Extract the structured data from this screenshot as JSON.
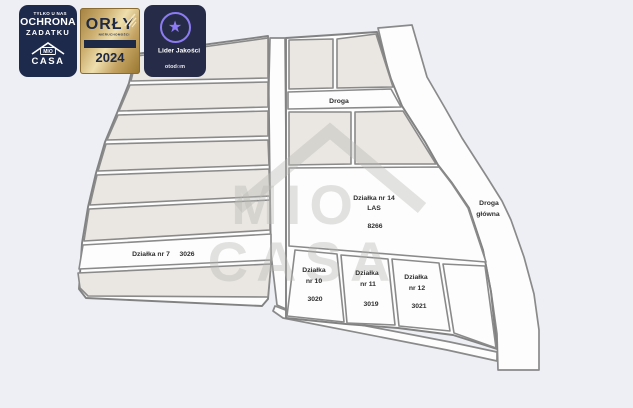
{
  "page": {
    "background": "#edeff5"
  },
  "badges": {
    "deposit": {
      "top_line": "TYLKO U NAS",
      "title": "OCHRONA",
      "subtitle": "ZADATKU",
      "logo_top": "MIO",
      "logo_bottom": "CASA",
      "bg": "#1e2a4c"
    },
    "award": {
      "title": "ORŁY",
      "subtitle": "NIERUCHOMOŚCI",
      "band": "LAUREAT KONKURSU",
      "year": "2024",
      "text_color": "#1d2945"
    },
    "quality": {
      "title": "Lider Jakości",
      "brand_prefix": "otod",
      "brand_accent": "o",
      "brand_suffix": "m",
      "accent_color": "#2fd594",
      "star_color": "#8d7bf5",
      "bg": "#262c47"
    }
  },
  "map": {
    "watermark": {
      "line1": "MIO",
      "line2": "CASA"
    },
    "roads": {
      "cross_road": "Droga",
      "main_road_line1": "Droga",
      "main_road_line2": "główna"
    },
    "plots": {
      "plot7": {
        "name": "Działka nr 7",
        "area": "3026"
      },
      "plot14": {
        "name": "Działka nr 14",
        "note": "LAS",
        "area": "8266"
      },
      "plot10": {
        "name": "Działka",
        "nr": "nr 10",
        "area": "3020"
      },
      "plot11": {
        "name": "Działka",
        "nr": "nr 11",
        "area": "3019"
      },
      "plot12": {
        "name": "Działka",
        "nr": "nr 12",
        "area": "3021"
      }
    },
    "colors": {
      "parcel_fill": "#eae7e2",
      "highlight_fill": "#fdfdfd",
      "boundary": "#8a8a8a",
      "background": "#edeff5"
    }
  }
}
